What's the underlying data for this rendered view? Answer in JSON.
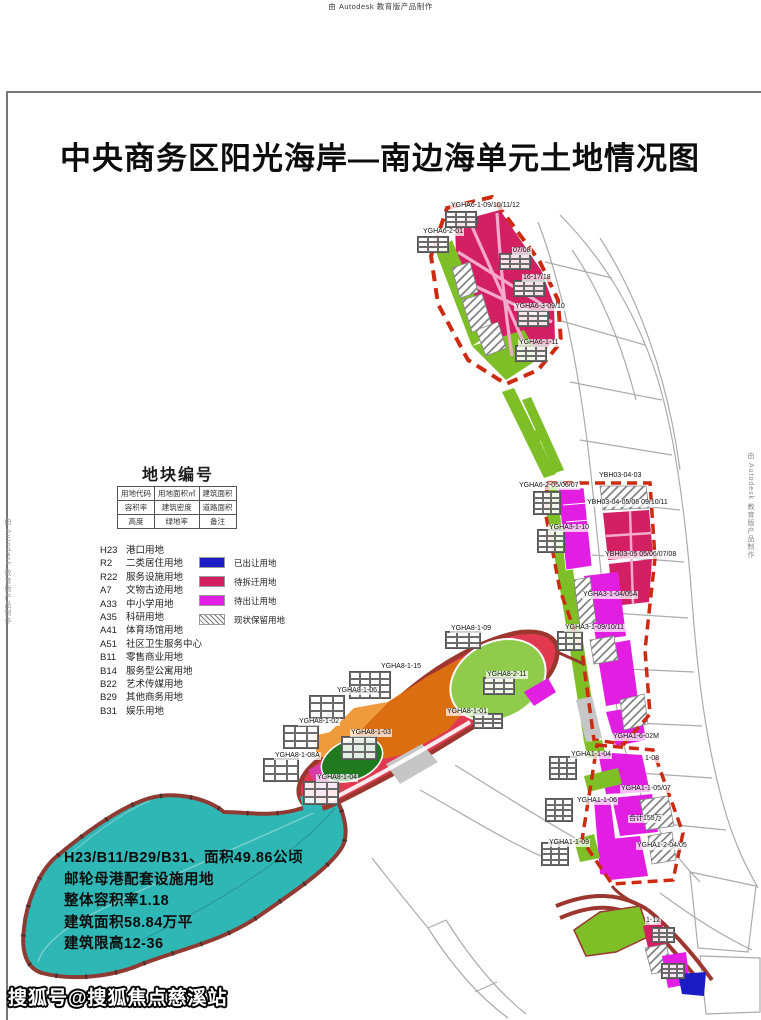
{
  "page": {
    "top_watermark": "由 Autodesk 教育版产品制作",
    "side_watermark": "由 Autodesk 教育版产品制作",
    "title": "中央商务区阳光海岸—南边海单元土地情况图",
    "bottom_watermark": "搜狐号@搜狐焦点慈溪站"
  },
  "legend": {
    "heading": "地块编号",
    "table": [
      [
        "用地代码",
        "用地面积㎡",
        "建筑面积"
      ],
      [
        "容积率",
        "建筑密度",
        "道路面积"
      ],
      [
        "高度",
        "绿地率",
        "备注"
      ]
    ],
    "land_use": [
      {
        "code": "H23",
        "name": "港口用地"
      },
      {
        "code": "R2",
        "name": "二类居住用地"
      },
      {
        "code": "R22",
        "name": "服务设施用地"
      },
      {
        "code": "A7",
        "name": "文物古迹用地"
      },
      {
        "code": "A33",
        "name": "中小学用地"
      },
      {
        "code": "A35",
        "name": "科研用地"
      },
      {
        "code": "A41",
        "name": "体育场馆用地"
      },
      {
        "code": "A51",
        "name": "社区卫生服务中心"
      },
      {
        "code": "B11",
        "name": "零售商业用地"
      },
      {
        "code": "B14",
        "name": "服务型公寓用地"
      },
      {
        "code": "B22",
        "name": "艺术传媒用地"
      },
      {
        "code": "B29",
        "name": "其他商务用地"
      },
      {
        "code": "B31",
        "name": "娱乐用地"
      }
    ],
    "status": [
      {
        "label": "已出让用地",
        "color": "#1C1CC4",
        "type": "solid"
      },
      {
        "label": "待拆迁用地",
        "color": "#D32063",
        "type": "solid"
      },
      {
        "label": "待出让用地",
        "color": "#E31EE3",
        "type": "solid"
      },
      {
        "label": "现状保留用地",
        "type": "hatch"
      }
    ]
  },
  "annotation": {
    "lines": [
      "H23/B11/B29/B31、面积49.86公顷",
      "邮轮母港配套设施用地",
      "整体容积率1.18",
      "建筑面积58.84万平",
      "建筑限高12-36"
    ]
  },
  "map": {
    "labels": [
      {
        "text": "YGHA6-1-09/10/11/12",
        "x": 450,
        "y": 202
      },
      {
        "text": "YGHA6-2-01",
        "x": 422,
        "y": 228
      },
      {
        "text": "07/08",
        "x": 512,
        "y": 247
      },
      {
        "text": "16-17/18",
        "x": 522,
        "y": 274
      },
      {
        "text": "YGHA6-3-09/10",
        "x": 514,
        "y": 303
      },
      {
        "text": "YGHA6-1-11",
        "x": 518,
        "y": 339
      },
      {
        "text": "YGHA6-2-05/06/07",
        "x": 518,
        "y": 482
      },
      {
        "text": "YBH03-04-03",
        "x": 598,
        "y": 472
      },
      {
        "text": "YBH03-04-05/06 09/10/11",
        "x": 586,
        "y": 499
      },
      {
        "text": "YBH03-05 05/06/07/08",
        "x": 604,
        "y": 551
      },
      {
        "text": "YGHA3-1-10",
        "x": 548,
        "y": 524
      },
      {
        "text": "YGHA3-1-04/05A",
        "x": 582,
        "y": 591
      },
      {
        "text": "YGHA3-1-09/10/11",
        "x": 564,
        "y": 624
      },
      {
        "text": "YGHA8-1-09",
        "x": 450,
        "y": 625
      },
      {
        "text": "YGHA8-1-15",
        "x": 380,
        "y": 663
      },
      {
        "text": "YGHA8-1-06",
        "x": 336,
        "y": 687
      },
      {
        "text": "YGHA8-1-02",
        "x": 298,
        "y": 718
      },
      {
        "text": "YGHA8-1-03",
        "x": 350,
        "y": 729
      },
      {
        "text": "YGHA8-1-08A",
        "x": 274,
        "y": 752
      },
      {
        "text": "YGHA8-1-04",
        "x": 316,
        "y": 774
      },
      {
        "text": "YGHA8-2-11",
        "x": 486,
        "y": 671
      },
      {
        "text": "YGHA8-1-01",
        "x": 446,
        "y": 708
      },
      {
        "text": "YGHA1-6-02M",
        "x": 612,
        "y": 733
      },
      {
        "text": "YGHA1-1-04",
        "x": 570,
        "y": 751
      },
      {
        "text": "1-08",
        "x": 644,
        "y": 755
      },
      {
        "text": "YGHA1-1-05/07",
        "x": 620,
        "y": 785
      },
      {
        "text": "YGHA1-1-06",
        "x": 576,
        "y": 797
      },
      {
        "text": "合计155万",
        "x": 628,
        "y": 815
      },
      {
        "text": "YGHA1-1-09",
        "x": 548,
        "y": 839
      },
      {
        "text": "YGHA1-2-04/05",
        "x": 636,
        "y": 842
      },
      {
        "text": "1-12",
        "x": 645,
        "y": 917
      }
    ],
    "attr_tables": [
      {
        "x": 446,
        "y": 212,
        "w": 30,
        "h": 15,
        "r": 3,
        "c": 3
      },
      {
        "x": 418,
        "y": 237,
        "w": 30,
        "h": 15,
        "r": 3,
        "c": 3
      },
      {
        "x": 500,
        "y": 254,
        "w": 30,
        "h": 15,
        "r": 3,
        "c": 3
      },
      {
        "x": 514,
        "y": 281,
        "w": 30,
        "h": 15,
        "r": 3,
        "c": 3
      },
      {
        "x": 518,
        "y": 311,
        "w": 30,
        "h": 15,
        "r": 3,
        "c": 3
      },
      {
        "x": 516,
        "y": 346,
        "w": 30,
        "h": 15,
        "r": 3,
        "c": 3
      },
      {
        "x": 534,
        "y": 492,
        "w": 26,
        "h": 22,
        "r": 4,
        "c": 3
      },
      {
        "x": 538,
        "y": 530,
        "w": 26,
        "h": 22,
        "r": 4,
        "c": 3
      },
      {
        "x": 558,
        "y": 632,
        "w": 24,
        "h": 18,
        "r": 3,
        "c": 3
      },
      {
        "x": 350,
        "y": 672,
        "w": 40,
        "h": 26,
        "r": 4,
        "c": 4
      },
      {
        "x": 310,
        "y": 696,
        "w": 34,
        "h": 22,
        "r": 3,
        "c": 3
      },
      {
        "x": 284,
        "y": 726,
        "w": 34,
        "h": 22,
        "r": 3,
        "c": 3
      },
      {
        "x": 342,
        "y": 737,
        "w": 34,
        "h": 22,
        "r": 3,
        "c": 3
      },
      {
        "x": 264,
        "y": 759,
        "w": 34,
        "h": 22,
        "r": 3,
        "c": 3
      },
      {
        "x": 304,
        "y": 782,
        "w": 34,
        "h": 22,
        "r": 3,
        "c": 3
      },
      {
        "x": 446,
        "y": 632,
        "w": 34,
        "h": 16,
        "r": 3,
        "c": 3
      },
      {
        "x": 484,
        "y": 678,
        "w": 30,
        "h": 16,
        "r": 3,
        "c": 3
      },
      {
        "x": 474,
        "y": 714,
        "w": 28,
        "h": 14,
        "r": 3,
        "c": 3
      },
      {
        "x": 550,
        "y": 757,
        "w": 26,
        "h": 22,
        "r": 4,
        "c": 3
      },
      {
        "x": 546,
        "y": 799,
        "w": 26,
        "h": 22,
        "r": 4,
        "c": 3
      },
      {
        "x": 542,
        "y": 843,
        "w": 26,
        "h": 22,
        "r": 4,
        "c": 3
      },
      {
        "x": 652,
        "y": 928,
        "w": 22,
        "h": 14,
        "r": 3,
        "c": 3
      },
      {
        "x": 662,
        "y": 964,
        "w": 22,
        "h": 14,
        "r": 3,
        "c": 3
      }
    ],
    "map_colors": {
      "transferred_blue": "#1C1CC4",
      "pending_demolition_crimson": "#D32063",
      "pending_transfer_magenta": "#E31EE3",
      "green_space": "#7EBF28",
      "park_green": "#90CB4B",
      "dark_green": "#207A20",
      "orange_parcel": "#DC6E12",
      "orange_light": "#EF9A3C",
      "water_teal": "#2FB7B5",
      "road_dark_red": "#9C372F",
      "boundary_red": "#CC2B12",
      "road_pink": "#F5A9CC",
      "street_gray": "#ABABAB"
    }
  }
}
